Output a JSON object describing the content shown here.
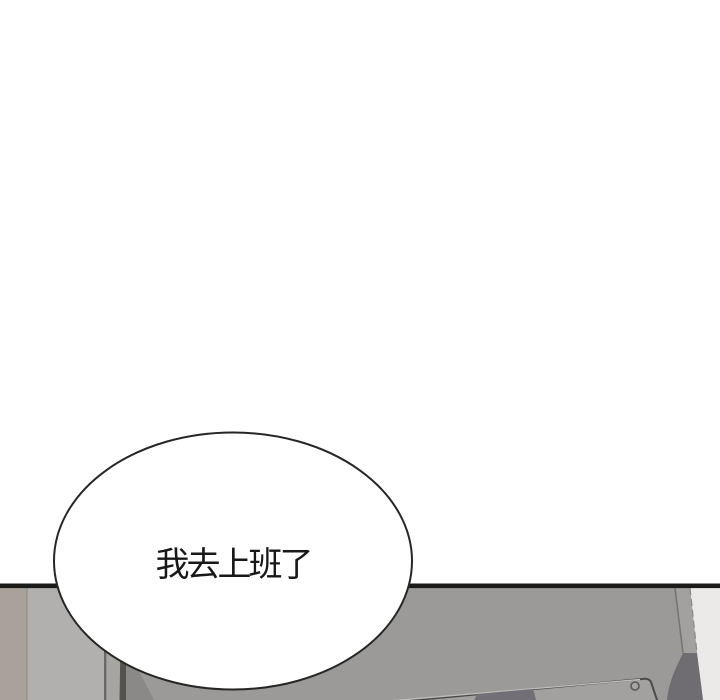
{
  "panel": {
    "kind": "webtoon-comic-panel"
  },
  "speech_bubble": {
    "text": "我去上班了"
  },
  "colors": {
    "panel_bg": "#ffffff",
    "divider_line": "#1b1b19",
    "table_surface": "#9c9a98",
    "floor_strip_left": "#a8a29b",
    "floor_strip_divider": "#8c8c86",
    "wall_light": "#b2b0ae",
    "wall_panel_line": "#6b6966",
    "wall_mid": "#a7a5a2",
    "corner_dark_stripe": "#54524e",
    "corner_shadow": "#8b8987",
    "table_edge_bevel": "#a3a19f",
    "table_edge_line": "#77756f",
    "table_edge_dash": "#8a8882",
    "table_side_dark": "#6f6d71",
    "background_right": "#eceae8",
    "device_surface": "#a3a19f",
    "device_edge": "#4c4a48",
    "device_highlight": "#bebcba",
    "device_dark_slab": "#727076",
    "screw_ring": "#5a5855",
    "screw_fill": "#a7a5a3",
    "bubble_fill": "#ffffff",
    "bubble_outline": "#262624",
    "text_color": "#181818"
  }
}
